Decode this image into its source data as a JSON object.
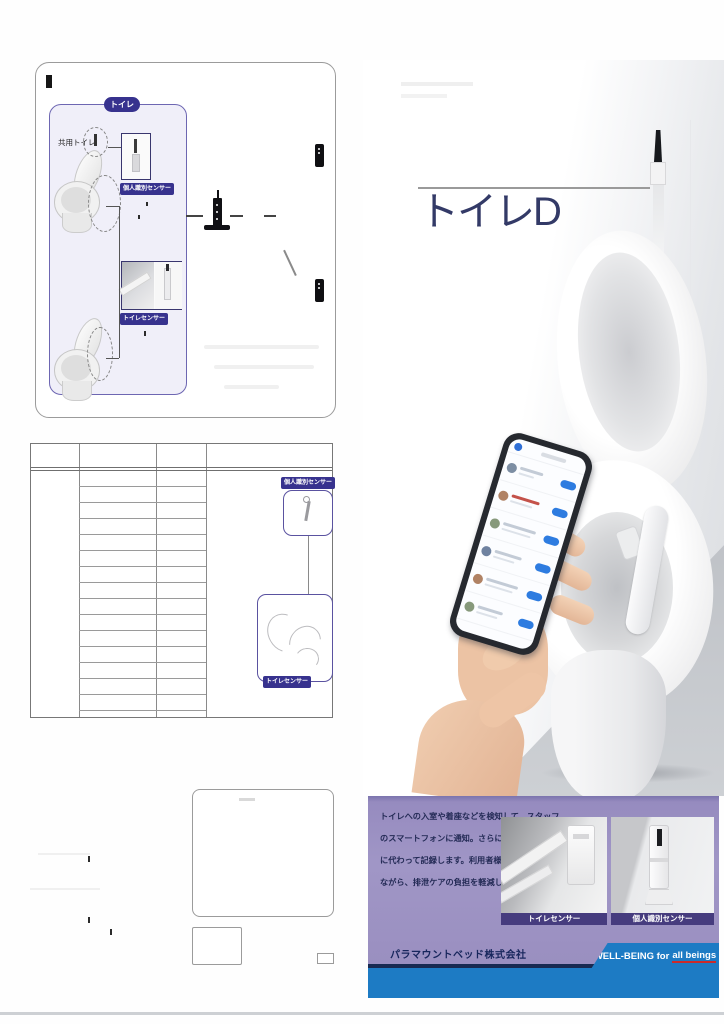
{
  "doc": {
    "diagram": {
      "zone_label": "トイレ",
      "shared_toilet_label": "共用トイレ"
    },
    "labels": {
      "personal_sensor": "個人識別センサー",
      "toilet_sensor": "トイレセンサー"
    },
    "spec_table": {
      "row_count": 15
    },
    "brochure": {
      "title": "トイレD",
      "description_lines": [
        "トイレへの入室や着座などを検知して、スタッフ",
        "のスマートフォンに通知。さらに排泄内容を人",
        "に代わって記録します。利用者様の尊厳を守り",
        "ながら、排泄ケアの負担を軽減します。"
      ],
      "photo_captions": [
        "トイレセンサー",
        "個人識別センサー"
      ],
      "company_name": "パラマウントベッド株式会社",
      "tagline": "WELL-BEING for",
      "tagline_emphasis": "all beings"
    },
    "colors": {
      "accent_indigo": "#37328e",
      "caption_purple": "#463c7e",
      "panel_lavender": "#9c91c3",
      "footer_blue": "#1d7bc4",
      "footer_navy": "#182a52"
    }
  }
}
